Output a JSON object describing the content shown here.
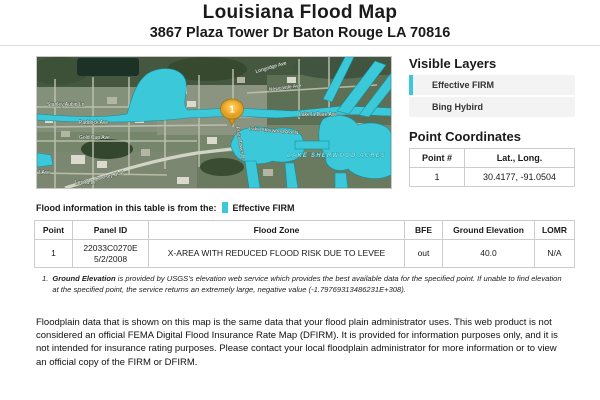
{
  "page": {
    "title": "Louisiana Flood Map",
    "subtitle": "3867 Plaza Tower Dr Baton Rouge LA 70816"
  },
  "map": {
    "marker_number": "1",
    "flood_overlay_color": "#3bc8d9",
    "labels": {
      "stanley": "Stanley Aubin Ln",
      "paddock": "Paddock Ave",
      "goldcup": "Gold Cup Ave",
      "iave": "I Ave",
      "letord": "Letord Dr",
      "longridge": "Longridge Ave",
      "newcastle": "Newcastle Ave",
      "lakeladare": "Lake la Dare Ave",
      "lakesherwood_n": "Lake Sherwood Ave N",
      "plazatower": "Plaza Tower Dr",
      "coursey": "Coursey Blvd",
      "acres": "LAKE SHERWOOD ACRES"
    }
  },
  "layers_panel": {
    "heading": "Visible Layers",
    "items": [
      {
        "label": "Effective FIRM",
        "active": true
      },
      {
        "label": "Bing Hybird",
        "active": false
      }
    ]
  },
  "coordinates_panel": {
    "heading": "Point Coordinates",
    "columns": {
      "point": "Point #",
      "latlong": "Lat., Long."
    },
    "rows": [
      {
        "point": "1",
        "latlong": "30.4177, -91.0504"
      }
    ]
  },
  "flood_info": {
    "prefix": "Flood information in this table is from the:",
    "source": "Effective FIRM"
  },
  "flood_table": {
    "columns": {
      "point": "Point",
      "panel_id": "Panel ID",
      "flood_zone": "Flood Zone",
      "bfe": "BFE",
      "ground_elevation": "Ground Elevation",
      "lomr": "LOMR"
    },
    "rows": [
      {
        "point": "1",
        "panel_id_line1": "22033C0270E",
        "panel_id_line2": "5/2/2008",
        "flood_zone": "X-AREA WITH REDUCED FLOOD RISK DUE TO LEVEE",
        "bfe": "out",
        "ground_elevation": "40.0",
        "lomr": "N/A"
      }
    ]
  },
  "footnote": {
    "number": "1.",
    "term": "Ground Elevation",
    "text": "is provided by USGS's elevation web service which provides the best available data for the specified point. If unable to find elevation at the specified point, the service returns an extremely large, negative value (-1.79769313486231E+308)."
  },
  "disclaimer": "Floodplain data that is shown on this map is the same data that your flood plain administrator uses. This web product is not considered an official FEMA Digital Flood Insurance Rate Map (DFIRM). It is provided for information purposes only, and it is not intended for insurance rating purposes. Please contact your local floodplain administrator for more information or to view an official copy of the FIRM or DFIRM."
}
